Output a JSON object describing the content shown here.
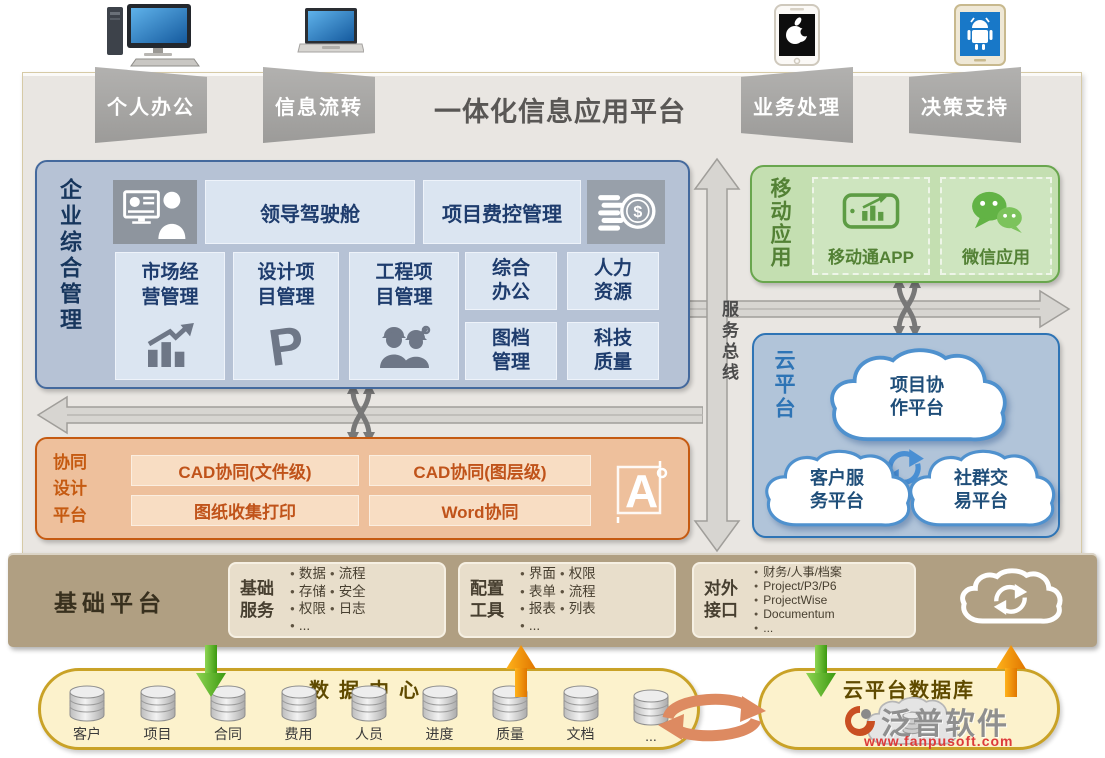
{
  "header": {
    "title": "一体化信息应用平台",
    "tabs": [
      "个人办公",
      "信息流转",
      "业务处理",
      "决策支持"
    ]
  },
  "enterprise": {
    "label": "企业综合管理",
    "cockpit": "领导驾驶舱",
    "cost": "项目费控管理",
    "modules": [
      "市场经营管理",
      "设计项目管理",
      "工程项目管理"
    ],
    "cells": [
      "综合办公",
      "人力资源",
      "图档管理",
      "科技质量"
    ]
  },
  "service_bus": {
    "label": "服务总线"
  },
  "mobile": {
    "label": "移动应用",
    "app": "移动通APP",
    "wechat": "微信应用"
  },
  "cloud_platform": {
    "label": "云平台",
    "clouds": [
      "项目协作平台",
      "客户服务平台",
      "社群交易平台"
    ]
  },
  "design_platform": {
    "label": "协同设计平台",
    "cells": [
      "CAD协同(文件级)",
      "CAD协同(图层级)",
      "图纸收集打印",
      "Word协同"
    ]
  },
  "base_platform": {
    "label": "基础平台",
    "services": {
      "name": "基础服务",
      "col1": [
        "数据",
        "存储",
        "权限",
        "..."
      ],
      "col2": [
        "流程",
        "安全",
        "日志"
      ]
    },
    "tools": {
      "name": "配置工具",
      "col1": [
        "界面",
        "表单",
        "报表",
        "..."
      ],
      "col2": [
        "权限",
        "流程",
        "列表"
      ]
    },
    "interfaces": {
      "name": "对外接口",
      "items": [
        "财务/人事/档案",
        "Project/P3/P6",
        "ProjectWise",
        "Documentum",
        "..."
      ]
    }
  },
  "data_center": {
    "title": "数据中心",
    "databases": [
      "客户",
      "项目",
      "合同",
      "费用",
      "人员",
      "进度",
      "质量",
      "文档",
      "..."
    ]
  },
  "cloud_db": {
    "title": "云平台数据库"
  },
  "watermark": {
    "brand": "泛普软件",
    "url": "www.fanpusoft.com"
  },
  "icons": {
    "top": [
      "desktop-computer-icon",
      "laptop-icon",
      "iphone-apple-icon",
      "android-phone-icon"
    ],
    "inner": [
      "leader-dashboard-icon",
      "money-coins-icon",
      "bar-chart-icon",
      "p-project-icon",
      "construction-workers-icon",
      "mobile-app-chart-icon",
      "wechat-icon",
      "sync-icon",
      "cad-icon",
      "cloud-sync-icon",
      "cloud-database-icon",
      "database-cylinder-icon"
    ]
  },
  "colors": {
    "blue_border": "#44699d",
    "blue_bg": "#b6c2d5",
    "cell_bg": "#dbe5f1",
    "green_border": "#69a64e",
    "green_bg": "#c4dfb1",
    "cloud_border": "#2e74b5",
    "cloud_bg": "#b1c4d9",
    "orange_border": "#c55a11",
    "orange_bg": "#eec09c",
    "band_bg": "#b09f82",
    "stadium_bg": "#fcf2cc",
    "stadium_border": "#c9a227",
    "arrow_gray": "#d7d5d1",
    "arrow_green": "#4caf2e",
    "arrow_orange": "#f08c00"
  }
}
